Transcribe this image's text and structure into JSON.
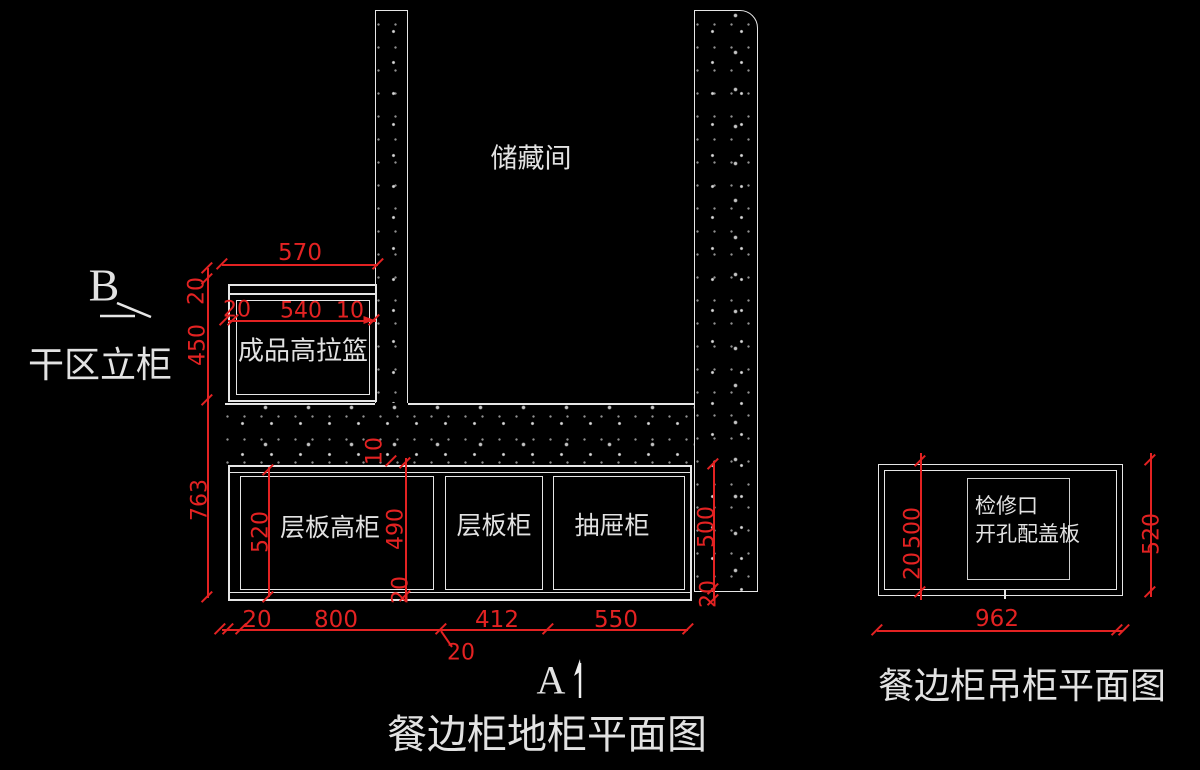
{
  "colors": {
    "background": "#000000",
    "drawing_line": "#e6e6e6",
    "dimension_red": "#e32222",
    "label_white": "#e2e2e2"
  },
  "base_plan": {
    "title": "餐边柜地柜平面图",
    "storage_label": "储藏间",
    "side_label": "干区立柜",
    "marker_a": "A",
    "marker_b": "B",
    "cabinet_labels": {
      "pull_basket": "成品高拉篮",
      "tall_shelf": "层板高柜",
      "shelf": "层板柜",
      "drawer": "抽屉柜"
    },
    "dims": {
      "top_570": "570",
      "chain_20": "20",
      "chain_540": "540",
      "chain_10": "10",
      "left_20": "20",
      "left_450": "450",
      "left_763": "763",
      "inner_520": "520",
      "inner_490": "490",
      "inner_10": "10",
      "inner_20": "20",
      "right_500": "500",
      "right_20": "20",
      "bottom_20": "20",
      "bottom_800": "800",
      "bottom_412": "412",
      "bottom_550": "550",
      "leader_20": "20"
    }
  },
  "wall_plan": {
    "title": "餐边柜吊柜平面图",
    "access_label_line1": "检修口",
    "access_label_line2": "开孔配盖板",
    "dims": {
      "left_500": "500",
      "left_20": "20",
      "right_520": "520",
      "bottom_962": "962"
    }
  }
}
